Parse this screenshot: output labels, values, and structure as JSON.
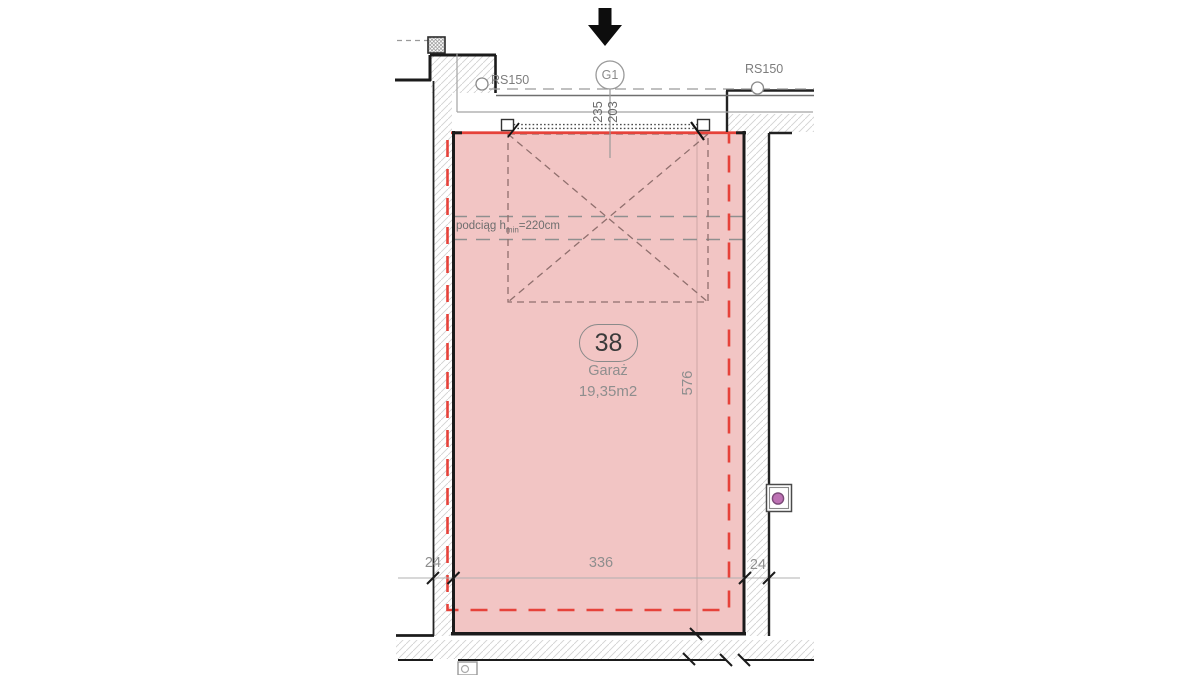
{
  "plan": {
    "grid_bubble": "G1",
    "rs150_left": "RS150",
    "rs150_right": "RS150",
    "door_dims": {
      "outer": "235",
      "inner": "203"
    },
    "beam_note": {
      "prefix": "podciąg h",
      "subscript": "min",
      "suffix": "=220cm"
    },
    "unit": {
      "number": "38",
      "type": "Garaż",
      "area": "19,35m2"
    },
    "dimensions": {
      "depth": "576",
      "width": "336",
      "wall_left": "24",
      "wall_right": "24"
    }
  },
  "colors": {
    "unit_fill": "#f2c5c4",
    "boundary_red": "#e6423a",
    "outlet_purple": "#bd72b4",
    "wall_black": "#1b1b1b",
    "line_gray": "#9a9a9a",
    "hatch_gray": "#d2d2d2"
  }
}
